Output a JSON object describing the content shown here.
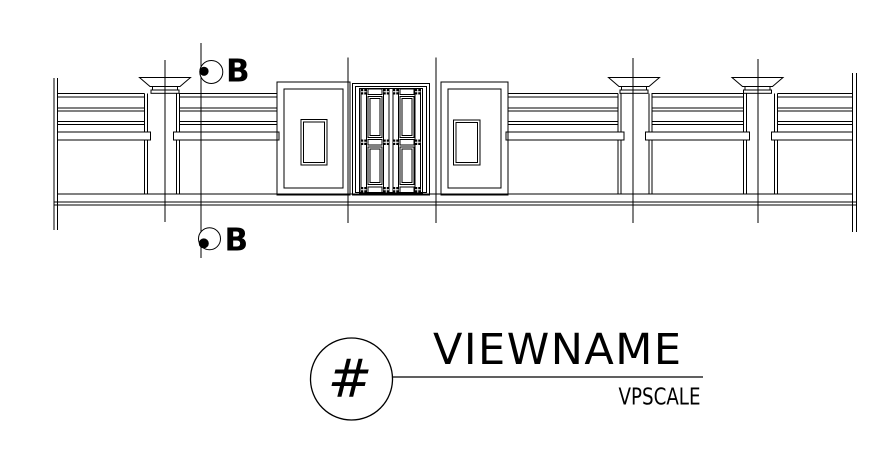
{
  "page": {
    "background_color": "#ffffff",
    "line_color": "#000000"
  },
  "elevation": {
    "description": "boundary-wall-elevation-with-central-gate",
    "section_markers": {
      "top_label": "B",
      "bottom_label": "B"
    }
  },
  "title_block": {
    "detail_symbol": "#",
    "view_name": "VIEWNAME",
    "view_scale": "VPSCALE"
  }
}
